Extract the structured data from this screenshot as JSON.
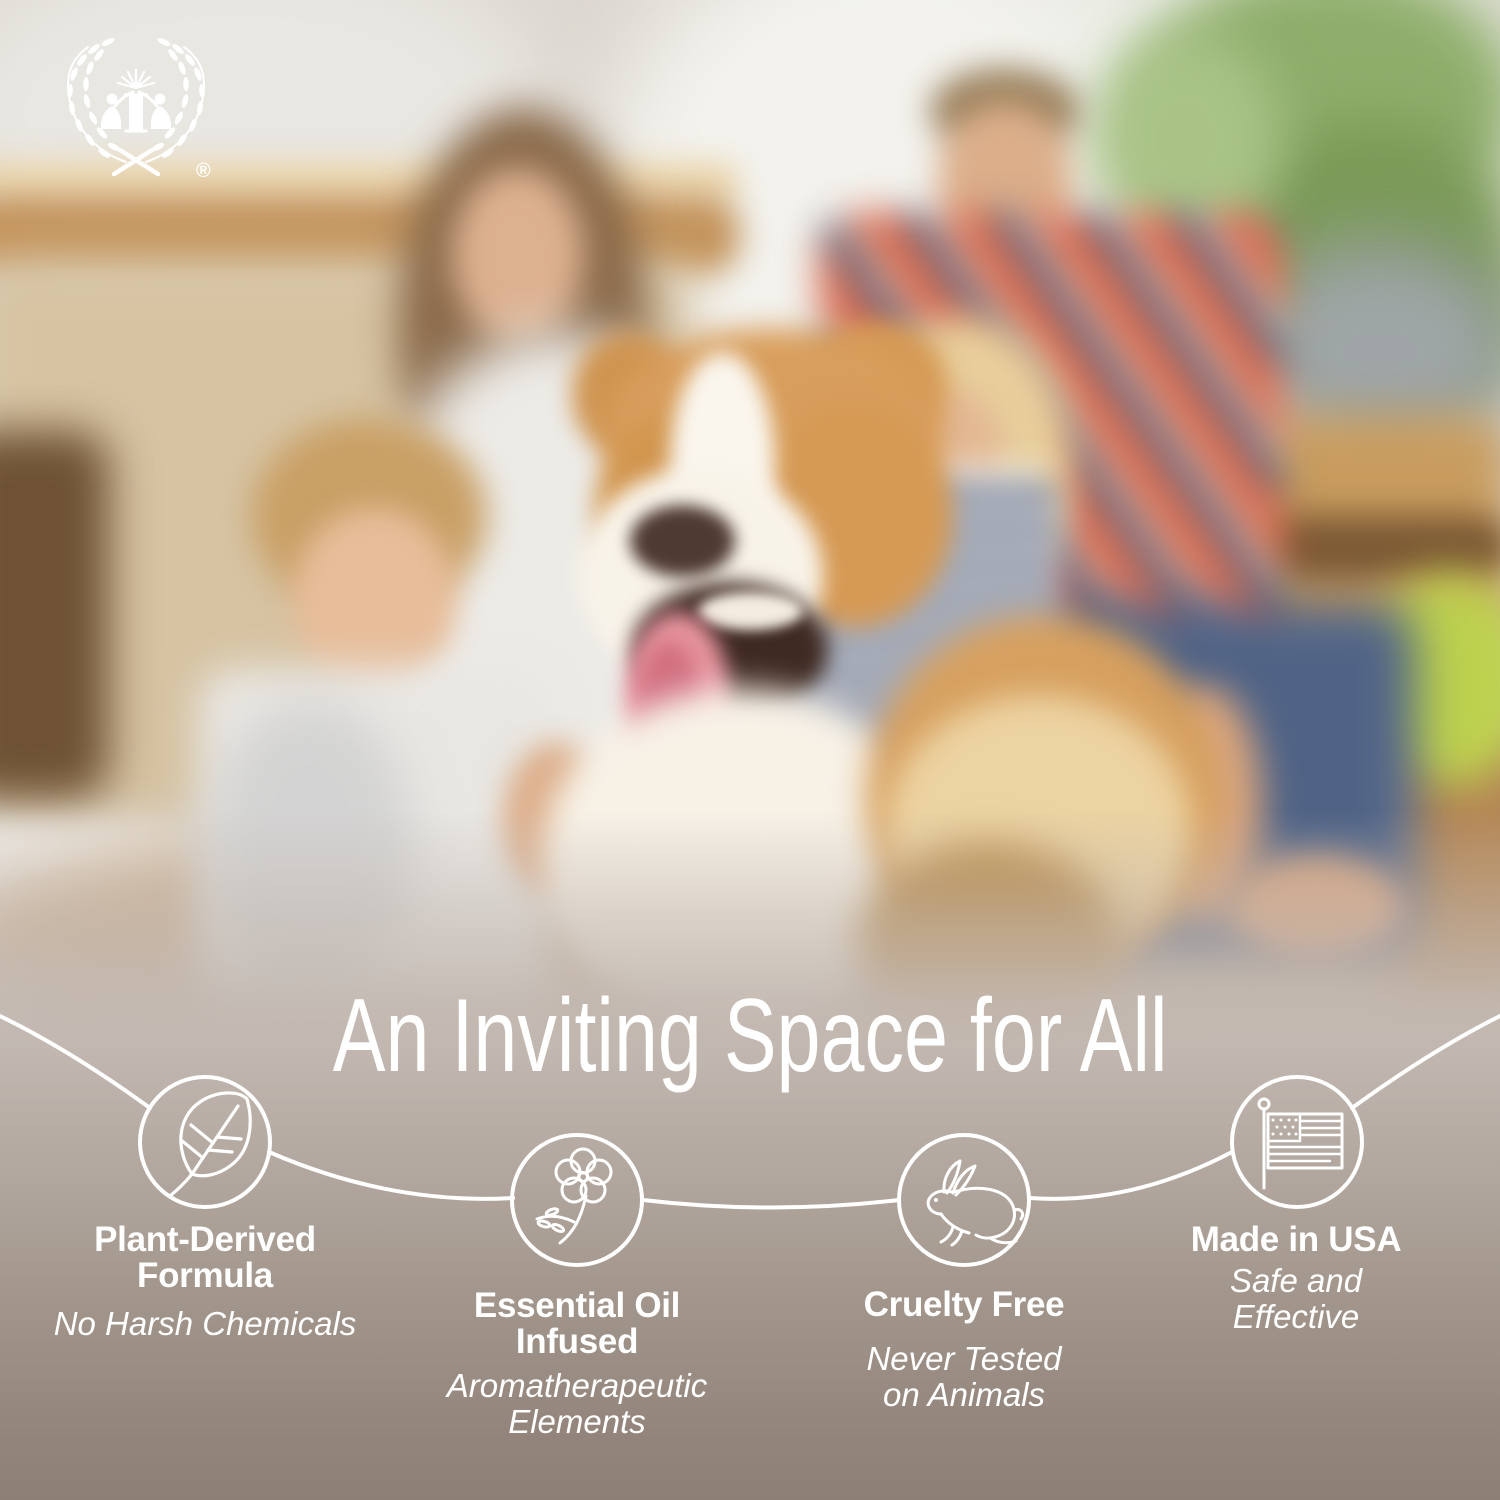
{
  "brand": {
    "logo": "laurel-wreath-two-figures-emblem",
    "registered_mark": "®"
  },
  "headline": "An Inviting Space for All",
  "features": [
    {
      "icon": "leaf-icon",
      "title_lines": [
        "Plant-Derived",
        "Formula"
      ],
      "subtitle_lines": [
        "No Harsh Chemicals"
      ]
    },
    {
      "icon": "flower-icon",
      "title_lines": [
        "Essential Oil",
        "Infused"
      ],
      "subtitle_lines": [
        "Aromatherapeutic",
        "Elements"
      ]
    },
    {
      "icon": "rabbit-icon",
      "title_lines": [
        "Cruelty Free"
      ],
      "subtitle_lines": [
        "Never Tested",
        "on Animals"
      ]
    },
    {
      "icon": "us-flag-icon",
      "title_lines": [
        "Made in USA"
      ],
      "subtitle_lines": [
        "Safe and",
        "Effective"
      ]
    }
  ],
  "colors": {
    "text": "#ffffff",
    "line_art": "#ffffff",
    "band_top": "#c2b8b1",
    "band_bottom": "#8d7f74"
  }
}
